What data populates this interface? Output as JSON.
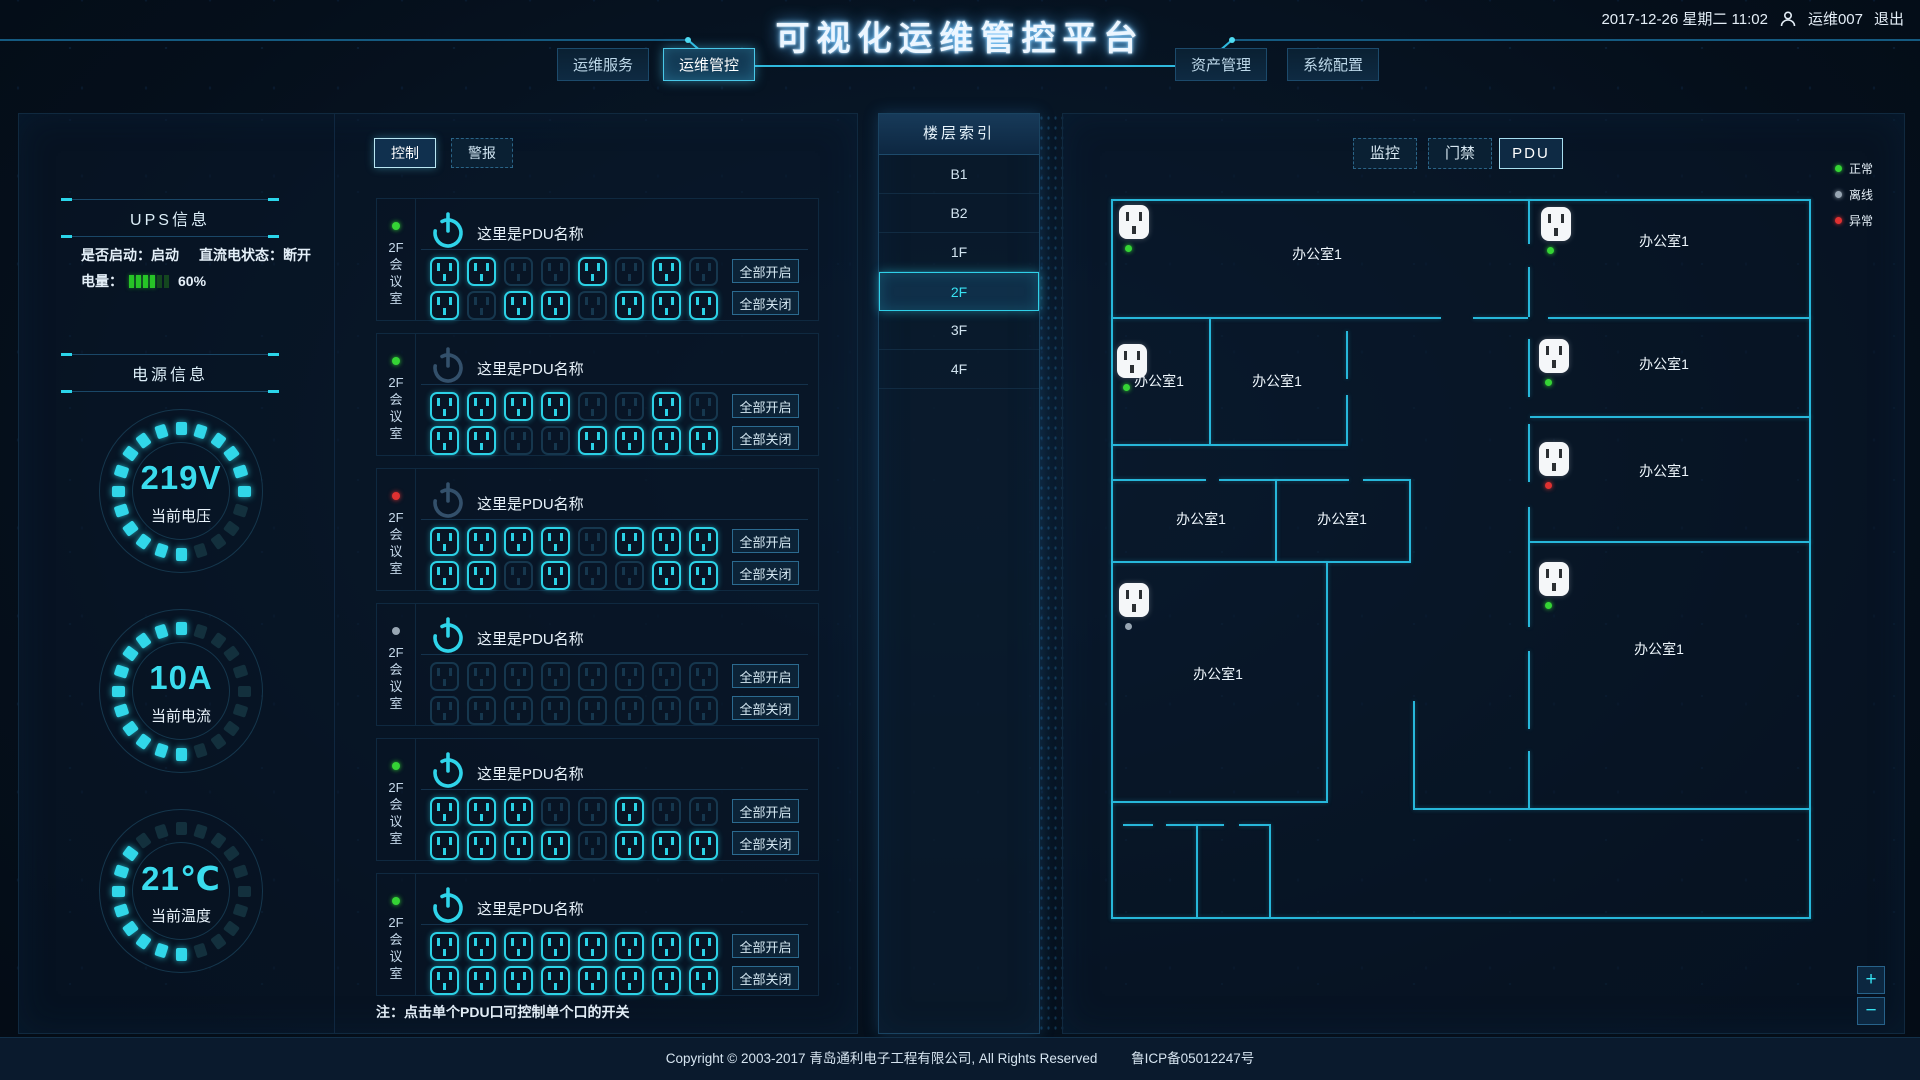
{
  "header": {
    "title": "可视化运维管控平台",
    "datetime": "2017-12-26 星期二 11:02",
    "user": "运维007",
    "logout": "退出",
    "nav": [
      {
        "label": "运维服务",
        "active": false
      },
      {
        "label": "运维管控",
        "active": true
      },
      {
        "label": "资产管理",
        "active": false
      },
      {
        "label": "系统配置",
        "active": false
      }
    ]
  },
  "left_panel": {
    "tabs": [
      {
        "label": "控制",
        "active": true
      },
      {
        "label": "警报",
        "active": false
      }
    ],
    "ups": {
      "title": "UPS信息",
      "start_label": "是否启动：启动",
      "dc_label": "直流电状态：断开",
      "battery_label": "电量：",
      "battery_percent": "60%",
      "battery_cells_on": 4,
      "battery_cells_total": 6
    },
    "power": {
      "title": "电源信息",
      "gauges": [
        {
          "value": "219V",
          "label": "当前电压",
          "segments_total": 20,
          "lit": [
            0,
            1,
            2,
            3,
            4,
            5,
            10,
            11,
            12,
            13,
            14,
            15,
            16,
            17,
            18,
            19
          ]
        },
        {
          "value": "10A",
          "label": "当前电流",
          "segments_total": 20,
          "lit": [
            0,
            10,
            11,
            12,
            13,
            14,
            15,
            16,
            17,
            18,
            19
          ]
        },
        {
          "value": "21℃",
          "label": "当前温度",
          "segments_total": 20,
          "lit": [
            10,
            11,
            12,
            13,
            14,
            15,
            16,
            17
          ]
        }
      ]
    },
    "pdu_buttons": {
      "all_on": "全部开启",
      "all_off": "全部关闭"
    },
    "pdu_note": "注：点击单个PDU口可控制单个口的开关",
    "pdus": [
      {
        "name": "这里是PDU名称",
        "location": "2F会议室",
        "status": "normal",
        "power_on": true,
        "outlets": [
          1,
          1,
          0,
          0,
          1,
          0,
          1,
          0,
          1,
          0,
          1,
          1,
          0,
          1,
          1,
          1
        ]
      },
      {
        "name": "这里是PDU名称",
        "location": "2F会议室",
        "status": "normal",
        "power_on": false,
        "outlets": [
          1,
          1,
          1,
          1,
          0,
          0,
          1,
          0,
          1,
          1,
          0,
          0,
          1,
          1,
          1,
          1
        ]
      },
      {
        "name": "这里是PDU名称",
        "location": "2F会议室",
        "status": "abnormal",
        "power_on": false,
        "outlets": [
          1,
          1,
          1,
          1,
          0,
          1,
          1,
          1,
          1,
          1,
          0,
          1,
          0,
          0,
          1,
          1
        ]
      },
      {
        "name": "这里是PDU名称",
        "location": "2F会议室",
        "status": "offline",
        "power_on": true,
        "outlets": [
          0,
          0,
          0,
          0,
          0,
          0,
          0,
          0,
          0,
          0,
          0,
          0,
          0,
          0,
          0,
          0
        ]
      },
      {
        "name": "这里是PDU名称",
        "location": "2F会议室",
        "status": "normal",
        "power_on": true,
        "outlets": [
          1,
          1,
          1,
          0,
          0,
          1,
          0,
          0,
          1,
          1,
          1,
          1,
          0,
          1,
          1,
          1
        ]
      },
      {
        "name": "这里是PDU名称",
        "location": "2F会议室",
        "status": "normal",
        "power_on": true,
        "outlets": [
          1,
          1,
          1,
          1,
          1,
          1,
          1,
          1,
          1,
          1,
          1,
          1,
          1,
          1,
          1,
          1
        ]
      }
    ]
  },
  "floor_index": {
    "title": "楼层索引",
    "floors": [
      {
        "label": "B1",
        "active": false
      },
      {
        "label": "B2",
        "active": false
      },
      {
        "label": "1F",
        "active": false
      },
      {
        "label": "2F",
        "active": true
      },
      {
        "label": "3F",
        "active": false
      },
      {
        "label": "4F",
        "active": false
      }
    ]
  },
  "right_panel": {
    "tabs": [
      {
        "label": "监控",
        "active": false
      },
      {
        "label": "门禁",
        "active": false
      },
      {
        "label": "PDU",
        "active": true
      }
    ],
    "legend": [
      {
        "label": "正常",
        "color": "#35d435"
      },
      {
        "label": "离线",
        "color": "#98a6b3"
      },
      {
        "label": "异常",
        "color": "#e03131"
      }
    ],
    "status_colors": {
      "normal": "#35d435",
      "offline": "#98a6b3",
      "abnormal": "#e03131"
    },
    "accent_color": "#2fd4ea",
    "plan": {
      "walls": [
        [
          0,
          0,
          700,
          2
        ],
        [
          0,
          718,
          700,
          2
        ],
        [
          0,
          0,
          2,
          720
        ],
        [
          698,
          0,
          2,
          720
        ],
        [
          0,
          118,
          330,
          2
        ],
        [
          362,
          118,
          55,
          2
        ],
        [
          437,
          118,
          263,
          2
        ],
        [
          419,
          217,
          281,
          2
        ],
        [
          419,
          342,
          281,
          2
        ],
        [
          302,
          609,
          398,
          2
        ],
        [
          302,
          502,
          2,
          107
        ],
        [
          0,
          245,
          237,
          2
        ],
        [
          98,
          120,
          2,
          125
        ],
        [
          235,
          132,
          2,
          48
        ],
        [
          235,
          196,
          2,
          49
        ],
        [
          0,
          280,
          95,
          2
        ],
        [
          108,
          280,
          130,
          2
        ],
        [
          252,
          280,
          46,
          2
        ],
        [
          164,
          280,
          2,
          82
        ],
        [
          298,
          280,
          2,
          82
        ],
        [
          0,
          362,
          300,
          2
        ],
        [
          215,
          362,
          2,
          240
        ],
        [
          0,
          602,
          217,
          2
        ],
        [
          12,
          625,
          30,
          2
        ],
        [
          55,
          625,
          58,
          2
        ],
        [
          128,
          625,
          30,
          2
        ],
        [
          85,
          625,
          2,
          93
        ],
        [
          158,
          625,
          2,
          93
        ],
        [
          417,
          0,
          2,
          45
        ],
        [
          417,
          68,
          2,
          50
        ],
        [
          417,
          140,
          2,
          58
        ],
        [
          417,
          225,
          2,
          58
        ],
        [
          417,
          308,
          2,
          120
        ],
        [
          417,
          452,
          2,
          78
        ],
        [
          417,
          552,
          2,
          57
        ]
      ],
      "rooms": [
        {
          "label": "办公室1",
          "x": 206,
          "y": 55
        },
        {
          "label": "办公室1",
          "x": 48,
          "y": 182
        },
        {
          "label": "办公室1",
          "x": 166,
          "y": 182
        },
        {
          "label": "办公室1",
          "x": 90,
          "y": 320
        },
        {
          "label": "办公室1",
          "x": 231,
          "y": 320
        },
        {
          "label": "办公室1",
          "x": 107,
          "y": 475
        },
        {
          "label": "办公室1",
          "x": 553,
          "y": 42
        },
        {
          "label": "办公室1",
          "x": 553,
          "y": 165
        },
        {
          "label": "办公室1",
          "x": 553,
          "y": 272
        },
        {
          "label": "办公室1",
          "x": 548,
          "y": 450
        }
      ],
      "outlets": [
        {
          "x": 8,
          "y": 6,
          "status": "normal"
        },
        {
          "x": 6,
          "y": 145,
          "status": "normal"
        },
        {
          "x": 8,
          "y": 384,
          "status": "offline"
        },
        {
          "x": 430,
          "y": 8,
          "status": "normal"
        },
        {
          "x": 428,
          "y": 140,
          "status": "normal"
        },
        {
          "x": 428,
          "y": 243,
          "status": "abnormal"
        },
        {
          "x": 428,
          "y": 363,
          "status": "normal"
        }
      ]
    },
    "zoom_controls": {
      "zoom_in": "+",
      "zoom_out": "−"
    }
  },
  "footer": {
    "copyright": "Copyright © 2003-2017 青岛通利电子工程有限公司, All Rights Reserved",
    "icp": "鲁ICP备05012247号"
  }
}
